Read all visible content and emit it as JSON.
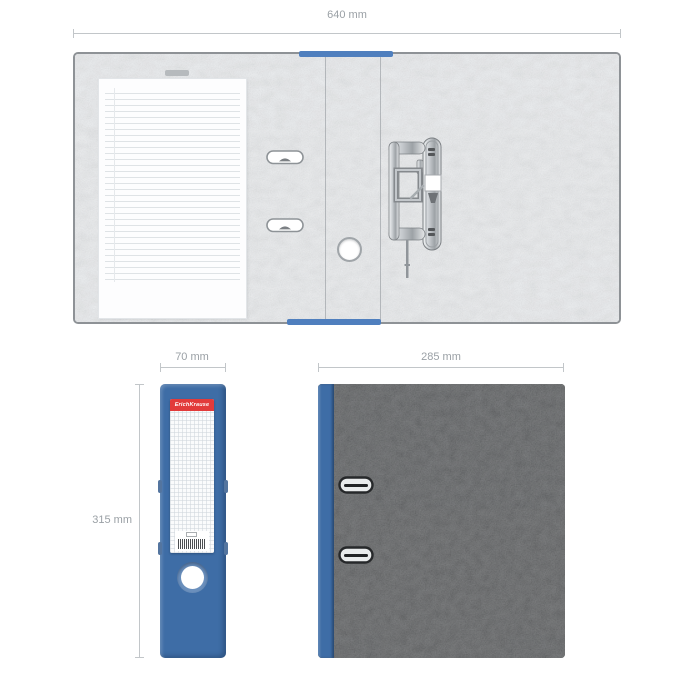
{
  "annotations": {
    "open_width": "640 mm",
    "spine_width": "70 mm",
    "binder_height": "315 mm",
    "cover_width": "285 mm"
  },
  "spine_label": {
    "brand_text": "ErichKrause"
  },
  "colors": {
    "binder_blue": "#3e6da6",
    "edge_blue": "#4f7fbe",
    "brand_red": "#e23b3b",
    "cover_charcoal": "#4b4d4f",
    "board_light": "#edeff1",
    "dimension_text": "#9aa0a5",
    "dimension_line": "#c2c6c9"
  }
}
